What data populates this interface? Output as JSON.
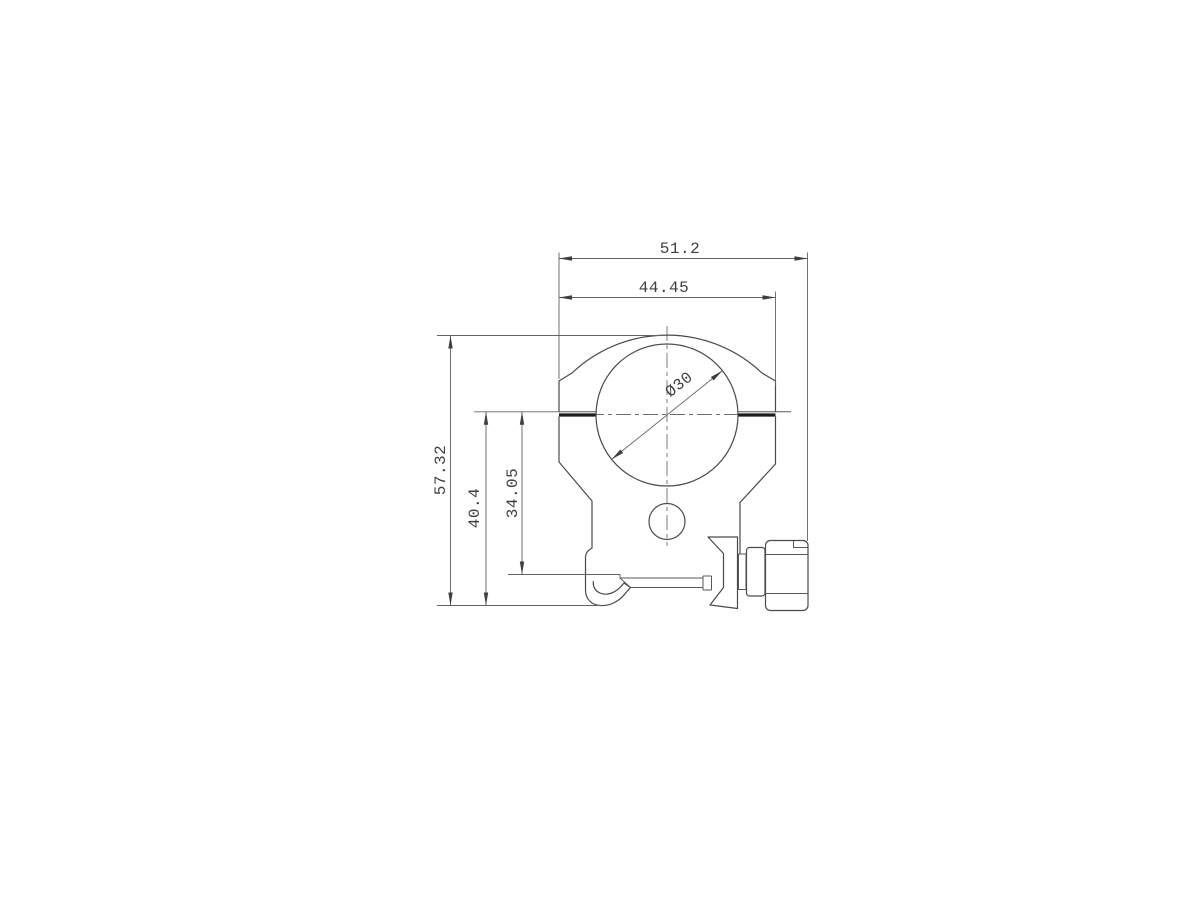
{
  "drawing": {
    "description": "Engineering dimension drawing of a 30mm scope ring mount, front cross-section view",
    "units": "mm",
    "labels": {
      "total_width": "51.2",
      "ring_cap_width": "44.45",
      "overall_height": "57.32",
      "base_height": "40.4",
      "saddle_height": "34.05",
      "bore_diameter": "Ø30"
    },
    "colors": {
      "background": "#ffffff",
      "outline": "#4a4a4a",
      "dimension": "#606060",
      "text": "#3f3f3f"
    }
  }
}
